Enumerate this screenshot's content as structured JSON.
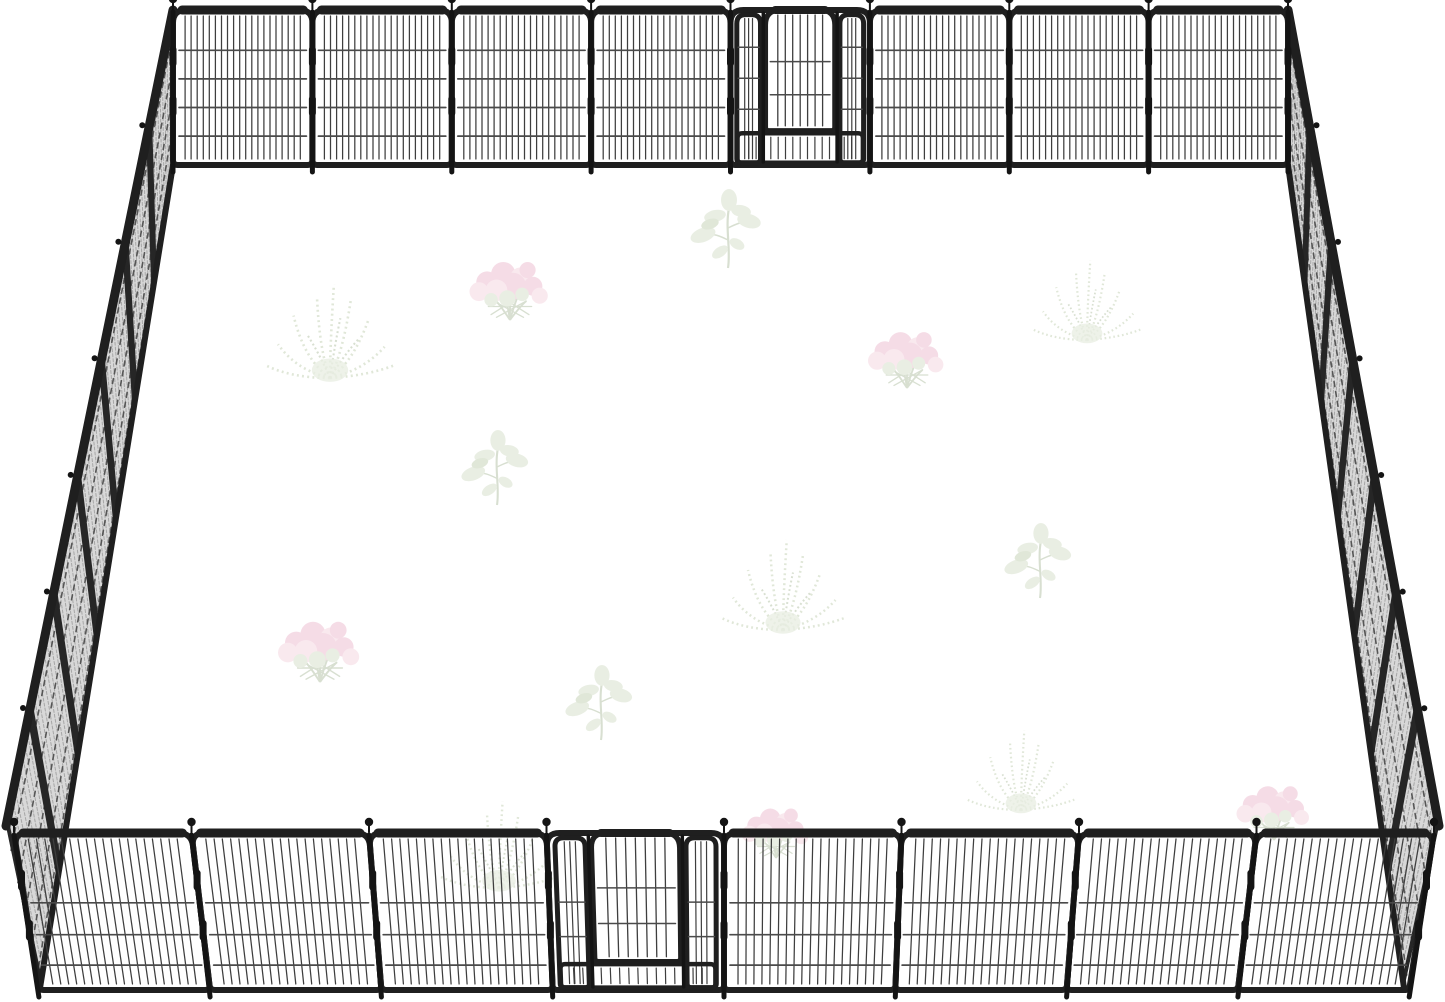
{
  "scene": {
    "background": "#ffffff",
    "subject": "metal-pet-playpen-enclosure",
    "colors": {
      "frame": "#1f1f1f",
      "bar": "#3e3e3e",
      "wire": "#4a4a4a",
      "post": "#141414",
      "side_fill": "#d8d8d8",
      "side_hatch": "#a6a6a6",
      "side_wire": "#565656",
      "side_frame": "#262626",
      "leaf": "#ccd8be",
      "leaf_dark": "#b7c7a4",
      "stem": "#a3b592",
      "pink": "#e9aec6",
      "pink_light": "#f3cbd9"
    },
    "back_fence": {
      "x_start": 173,
      "x_end": 1288,
      "y_top": 10,
      "y_bottom": 165,
      "panels": 8,
      "gate_index": 4,
      "bars": 20,
      "wires": [
        0.24,
        0.44,
        0.64,
        0.84
      ],
      "k": 0,
      "door_bottom": 0.78
    },
    "front_fence": {
      "x_start": 14,
      "x_end": 1434,
      "y_top": 833,
      "y_bottom": 990,
      "panels": 8,
      "gate_index": 3,
      "bars": 19,
      "wires": [
        0.44,
        0.66,
        0.87
      ],
      "k": 0.035,
      "door_bottom": 0.82
    },
    "left_wall": {
      "a": [
        173,
        10
      ],
      "d": [
        6,
        826
      ],
      "c": [
        40,
        988
      ],
      "b": [
        173,
        165
      ],
      "panels": 7
    },
    "right_wall": {
      "a": [
        1288,
        10
      ],
      "d": [
        1439,
        826
      ],
      "c": [
        1404,
        988
      ],
      "b": [
        1288,
        165
      ],
      "panels": 7
    },
    "plants": [
      {
        "type": "eucalyptus",
        "x": 728,
        "y": 268,
        "s": 1.0
      },
      {
        "type": "flowers",
        "x": 510,
        "y": 320,
        "s": 1.35
      },
      {
        "type": "fern",
        "x": 330,
        "y": 378,
        "s": 1.3
      },
      {
        "type": "fern",
        "x": 1087,
        "y": 340,
        "s": 1.1
      },
      {
        "type": "flowers",
        "x": 907,
        "y": 388,
        "s": 1.3
      },
      {
        "type": "eucalyptus",
        "x": 497,
        "y": 505,
        "s": 0.95
      },
      {
        "type": "fern",
        "x": 783,
        "y": 630,
        "s": 1.25
      },
      {
        "type": "eucalyptus",
        "x": 1040,
        "y": 598,
        "s": 0.95
      },
      {
        "type": "flowers",
        "x": 320,
        "y": 682,
        "s": 1.4
      },
      {
        "type": "eucalyptus",
        "x": 601,
        "y": 740,
        "s": 0.95
      },
      {
        "type": "fern",
        "x": 1021,
        "y": 810,
        "s": 1.1
      },
      {
        "type": "flowers",
        "x": 1274,
        "y": 840,
        "s": 1.25
      },
      {
        "type": "fern",
        "x": 499,
        "y": 888,
        "s": 1.2
      },
      {
        "type": "flowers",
        "x": 776,
        "y": 858,
        "s": 1.15
      }
    ]
  }
}
